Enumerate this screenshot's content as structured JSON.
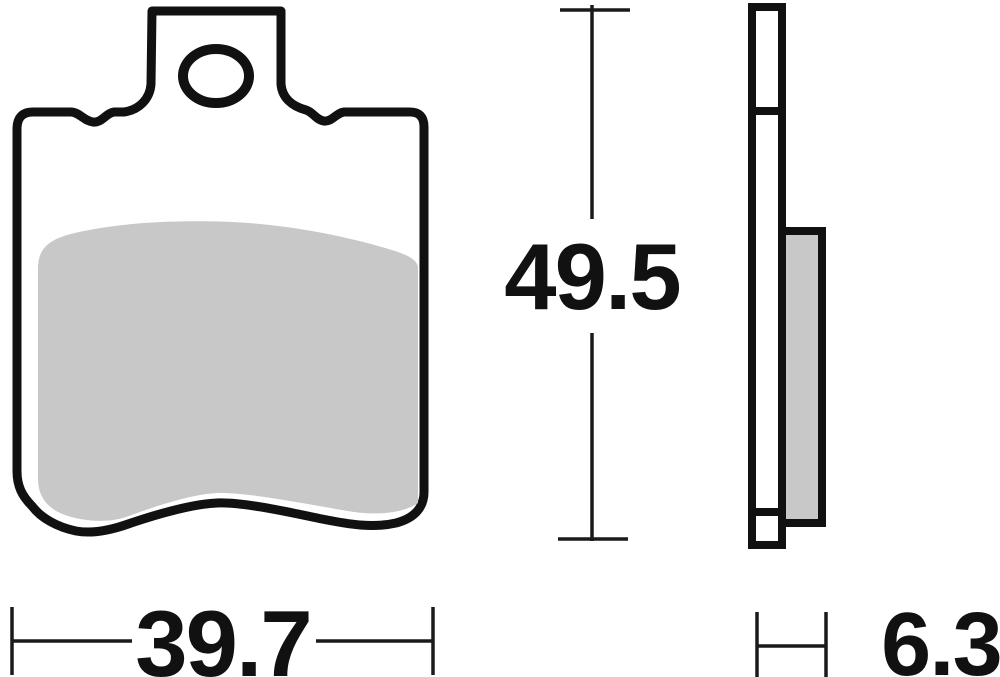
{
  "drawing": {
    "colors": {
      "background": "#ffffff",
      "outline": "#111111",
      "dim_line": "#1a1a1a",
      "friction_fill": "#c8c8c8"
    },
    "dimensions": {
      "height": {
        "value": "49.5"
      },
      "width": {
        "value": "39.7"
      },
      "thickness": {
        "value": "6.3"
      }
    }
  }
}
